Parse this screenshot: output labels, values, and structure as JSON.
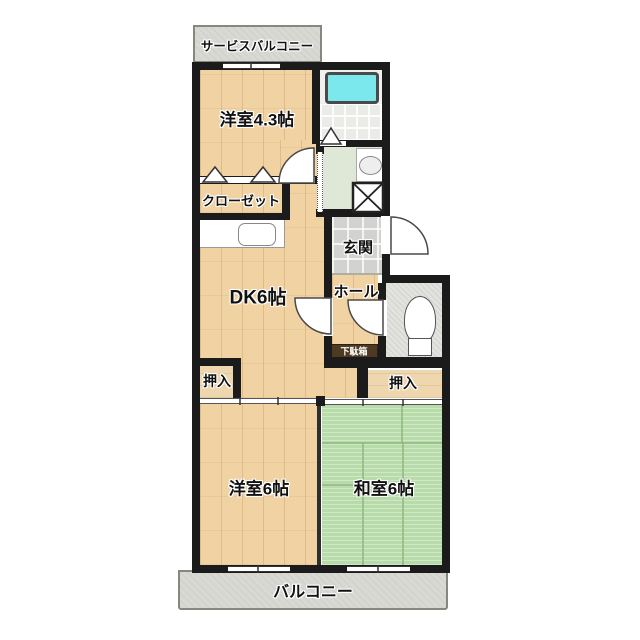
{
  "plan_type": "apartment-floor-plan-2DK",
  "labels": {
    "service_balcony": "サービスバルコニー",
    "western_room_43": "洋室4.3帖",
    "closet": "クローゼット",
    "dining_kitchen": "DK6帖",
    "entrance": "玄関",
    "hall": "ホール",
    "shoe_cabinet": "下駄箱",
    "oshiire_left": "押入",
    "oshiire_right": "押入",
    "western_room_6": "洋室6帖",
    "japanese_room_6": "和室6帖",
    "balcony": "バルコニー"
  },
  "fixtures": [
    {
      "name": "bathtub-icon"
    },
    {
      "name": "washbasin-icon"
    },
    {
      "name": "washing-machine-pan-icon"
    },
    {
      "name": "toilet-icon"
    },
    {
      "name": "kitchen-sink-icon"
    },
    {
      "name": "hinged-door-icon",
      "count": 4
    },
    {
      "name": "folding-door-icon",
      "count": 3
    },
    {
      "name": "sliding-door-icon",
      "count": 4
    }
  ],
  "colors": {
    "wall": "#1b1b1b",
    "wood_floor": "#f1d2a2",
    "tatami": "#b7dcaa",
    "bathtub": "#7be8ed",
    "balcony_gray": "#d9d9d4",
    "entrance_tile": "#d2d2d0",
    "washroom_floor": "#dfe7d6",
    "shoe_cabinet_brown": "#4e3a22"
  }
}
